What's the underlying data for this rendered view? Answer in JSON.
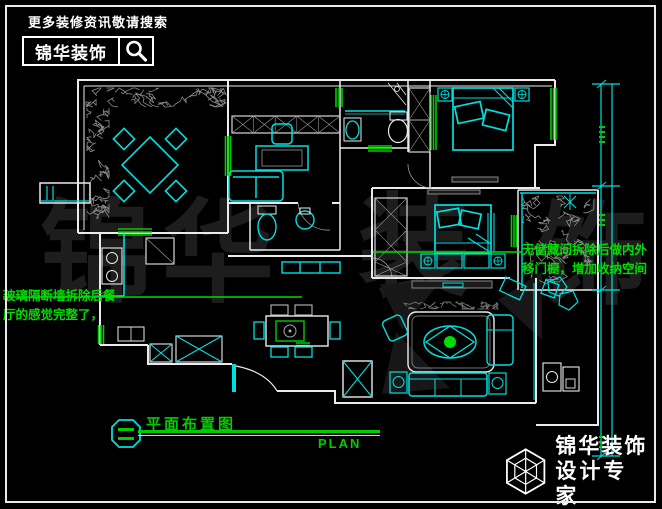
{
  "header": {
    "tagline": "更多装修资讯敬请搜索",
    "brand": "锦华装饰",
    "search_icon": "magnifier-icon"
  },
  "watermark": {
    "chars": [
      "锦",
      "华",
      "装",
      "饰"
    ]
  },
  "annotations": {
    "left": {
      "line1": "玻璃隔断墙拆除后餐",
      "line2": "厅的感觉完整了，"
    },
    "right": {
      "line1": "无储藏间拆除后做内外",
      "line2": "移门橱，增加收纳空间"
    }
  },
  "title_block": {
    "title": "平面布置图",
    "subtitle": "PLAN"
  },
  "brand_footer": {
    "brand": "锦华装饰",
    "tagline": "设计专家",
    "website": "WWW.JS-JINHUA.COM",
    "logo_icon": "cube-logo-icon"
  },
  "colors": {
    "background": "#000000",
    "wall": "#ebebeb",
    "cyan": "#00dfdf",
    "green": "#00cc00",
    "annotation": "#00dd00",
    "plant_gray": "#8c8c8c",
    "watermark": "#1d1d1d"
  }
}
